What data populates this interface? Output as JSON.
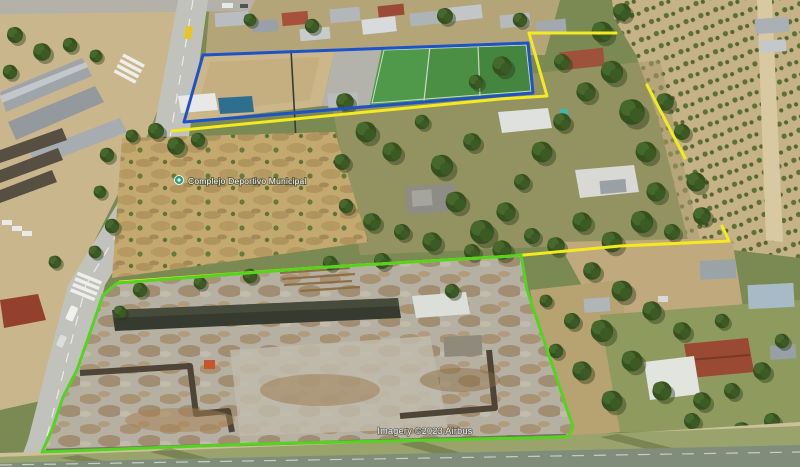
{
  "view": {
    "type": "aerial-oblique-satellite-imagery",
    "description": "Oblique aerial photo of suburban parcels with surveyed property boundary overlays"
  },
  "place_label": {
    "text": "Complejo Deportivo Municipal",
    "marker_icon": "place-marker-icon",
    "marker_color": "#2e9d78"
  },
  "watermark": {
    "text": "Imagery ©2023 Airbus"
  },
  "boundaries": {
    "sports_field": {
      "name": "sports-field-boundary",
      "color": "#1e53c8"
    },
    "upper_parcel": {
      "name": "upper-parcel-boundary",
      "color": "#f3ea1f"
    },
    "demolition_site": {
      "name": "demolition-site-boundary",
      "color": "#54d41f"
    }
  },
  "terrain_palette": {
    "dirt": "#c9b387",
    "scrub_field": "#c4a96f",
    "road": "#c2c2bd",
    "sports_turf": "#4a8f44",
    "concrete_site": "#b6b0a2",
    "tree_canopy": "#35511f",
    "grass_strip": "#9aa36b"
  }
}
